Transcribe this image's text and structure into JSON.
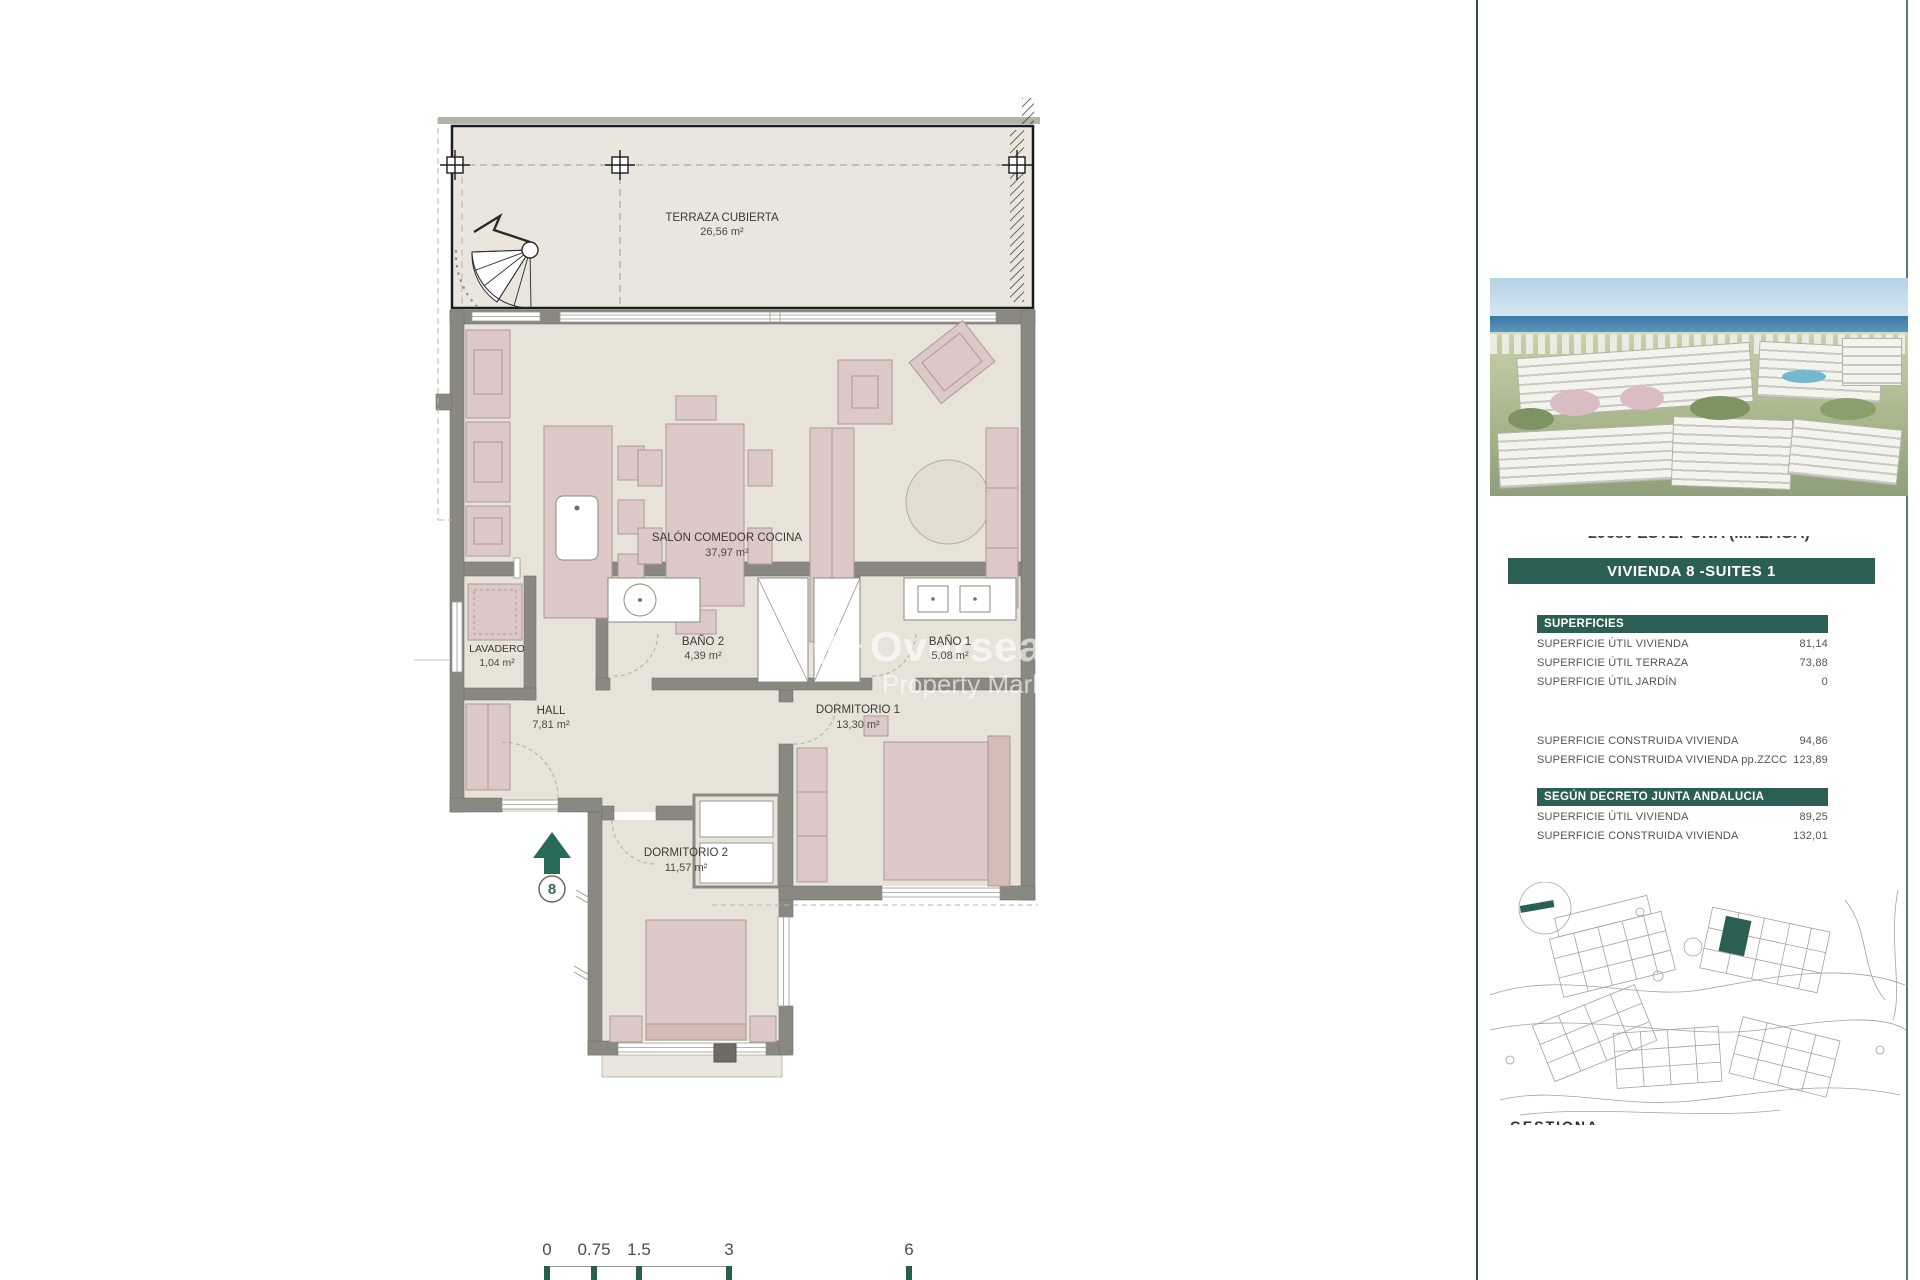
{
  "floor_plan": {
    "rooms": [
      {
        "name": "TERRAZA CUBIERTA",
        "area": "26,56 m²"
      },
      {
        "name": "SALÓN COMEDOR COCINA",
        "area": "37,97 m²"
      },
      {
        "name": "LAVADERO",
        "area": "1,04 m²"
      },
      {
        "name": "BAÑO 2",
        "area": "4,39 m²"
      },
      {
        "name": "BAÑO 1",
        "area": "5,08 m²"
      },
      {
        "name": "HALL",
        "area": "7,81 m²"
      },
      {
        "name": "DORMITORIO 1",
        "area": "13,30 m²"
      },
      {
        "name": "DORMITORIO 2",
        "area": "11,57 m²"
      }
    ],
    "entrance_number": "8",
    "watermark": {
      "line1": "Overseas",
      "line2": "Property Market"
    }
  },
  "scale_bar": {
    "labels": [
      "0",
      "0.75",
      "1.5",
      "3",
      "6"
    ]
  },
  "sidebar": {
    "address_clipped": "29680 ESTEPONA (MÁLAGA)",
    "unit_banner": "VIVIENDA 8 -SUITES 1",
    "superficies": {
      "header": "SUPERFICIES",
      "rows": [
        {
          "label": "SUPERFICIE ÚTIL VIVIENDA",
          "value": "81,14"
        },
        {
          "label": "SUPERFICIE ÚTIL TERRAZA",
          "value": "73,88"
        },
        {
          "label": "SUPERFICIE ÚTIL JARDÍN",
          "value": "0"
        },
        {
          "label": "SUPERFICIE CONSTRUIDA VIVIENDA",
          "value": "94,86"
        },
        {
          "label": "SUPERFICIE CONSTRUIDA VIVIENDA pp.ZZCC",
          "value": "123,89"
        }
      ]
    },
    "decreto": {
      "header": "SEGÚN DECRETO JUNTA ANDALUCIA",
      "rows": [
        {
          "label": "SUPERFICIE ÚTIL VIVIENDA",
          "value": "89,25"
        },
        {
          "label": "SUPERFICIE CONSTRUIDA VIVIENDA",
          "value": "132,01"
        }
      ]
    },
    "footer_clipped": "GESTIONA"
  },
  "colors": {
    "accent_green": "#2c5f53",
    "arrow_green": "#276a58",
    "wall_gray": "#898982",
    "room_beige": "#e8e3d8",
    "terrace_beige": "#eae6dd",
    "furniture_pink": "#dcc8c4"
  }
}
